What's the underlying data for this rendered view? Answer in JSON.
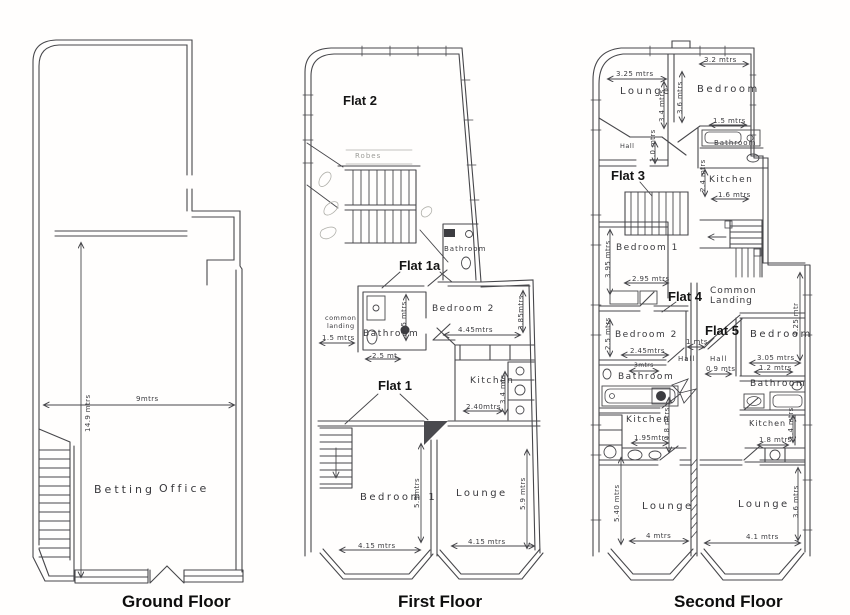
{
  "sheet": {
    "ground": {
      "caption": "Ground Floor",
      "rooms": {
        "betting": "Betting",
        "office": "Office"
      },
      "dims": {
        "width": "9mtrs",
        "depth": "14.9 mtrs"
      }
    },
    "first": {
      "caption": "First Floor",
      "flats": {
        "flat2": "Flat 2",
        "flat1a": "Flat 1a",
        "flat1": "Flat 1"
      },
      "rooms": {
        "robes": "Robes",
        "bathroom_top": "Bathroom",
        "common_landing_1": "common",
        "common_landing_2": "landing",
        "bathroom": "Bathroom",
        "bedroom2": "Bedroom 2",
        "kitchen": "Kitchen",
        "bedroom1": "Bedroom 1",
        "lounge": "Lounge"
      },
      "dims": {
        "landing_w": "1.5 mtrs",
        "bath_h": "2.5 mtrs",
        "bath_w": "2.5 mt",
        "bed2_w": "4.45mtrs",
        "bed2_h": "3.85mtrs",
        "kit_w": "2.40mtrs",
        "kit_h": "3.4 mts",
        "bed1_w": "4.15 mtrs",
        "lounge_w": "4.15 mtrs",
        "bed1_h": "5.9mtrs",
        "lounge_h": "5.9 mtrs"
      }
    },
    "second": {
      "caption": "Second Floor",
      "flats": {
        "flat3": "Flat 3",
        "flat4": "Flat 4",
        "flat5": "Flat 5"
      },
      "rooms": {
        "lounge_f3": "Lounge",
        "bedroom_f3": "Bedroom",
        "hall_f3": "Hall",
        "bathroom_f3": "Bathroom",
        "kitchen_f3": "Kitchen",
        "bedroom1_f4": "Bedroom 1",
        "common_1": "Common",
        "common_2": "Landing",
        "bedroom2_f4": "Bedroom 2",
        "hall_f4": "Hall",
        "hall_f5": "Hall",
        "bedroom_f5": "Bedroom",
        "bathroom_f4": "Bathroom",
        "kitchen_f4": "Kitchen",
        "bathroom_f5": "Bathroom",
        "kitchen_f5": "Kitchen",
        "lounge_f4": "Lounge",
        "lounge_f5": "Lounge"
      },
      "dims": {
        "lounge3_w": "3.25 mtrs",
        "bed3_w": "3.2 mtrs",
        "lounge3_h": "3.4 mtrs",
        "bed3_h": "3.6 mtrs",
        "bath3_w": "1.5 mtrs",
        "hall3_h": "1.0 mtrs",
        "kit3_w": "1.6 mtrs",
        "kit3_h": "2.4 mtrs",
        "bed1_h": "3.95 mtrs",
        "bed1_w": "2.95 mtrs",
        "bed2_h": "2.5 mtrs",
        "bed2_w": "2.45mtrs",
        "hall_w": "1 mts",
        "hall5_w": "0.9 mts",
        "bed5_w": "3.05 mtrs",
        "bed5_h": "4.25 mtr",
        "bath4_w": "3mtrs",
        "kit4_w": "1.95mtrs",
        "kit4_h": "1.8 mtrs",
        "lounge4_h": "5.40 mtrs",
        "lounge4_w": "4 mtrs",
        "bath5_w": "1.2 mtrs",
        "kit5_w": "1.8 mtrs",
        "kit5_h": "1.4 mtrs",
        "lounge5_w": "4.1 mtrs",
        "lounge5_h": "3.6 mtrs"
      }
    }
  }
}
